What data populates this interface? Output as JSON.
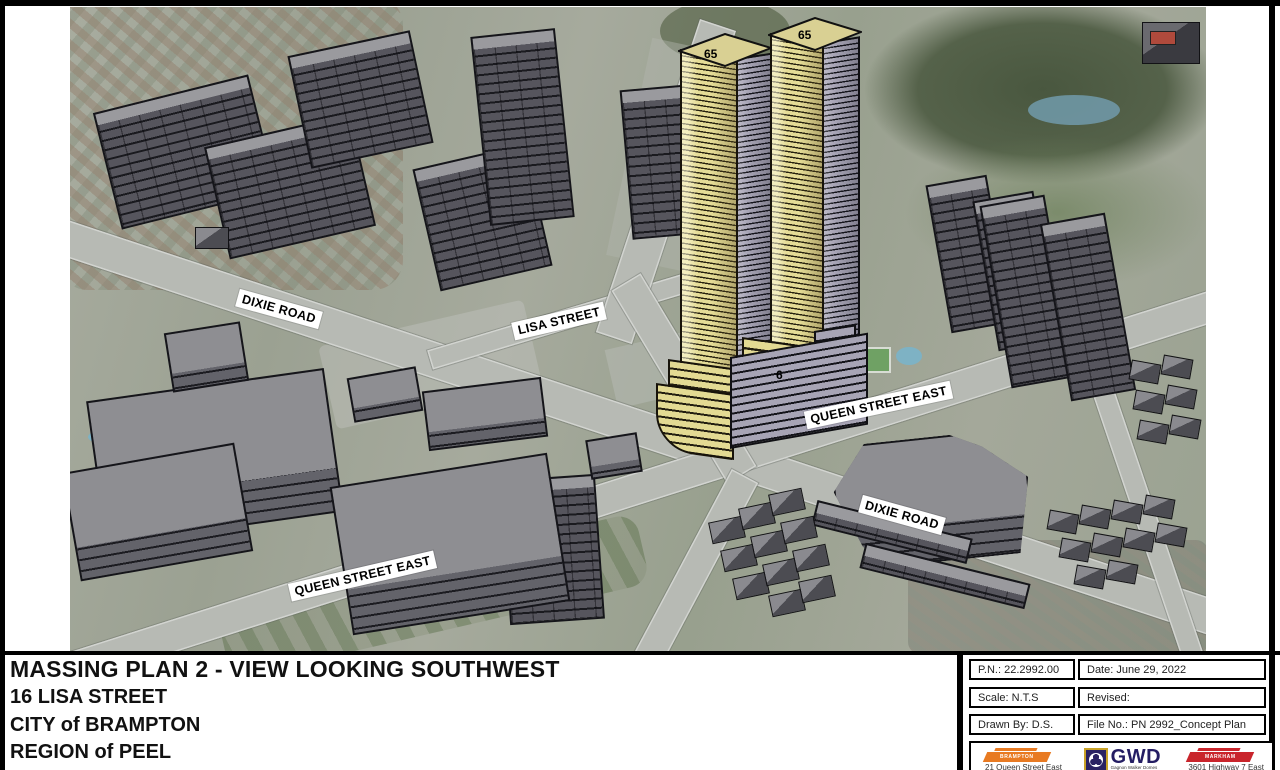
{
  "drawing": {
    "title": "MASSING PLAN 2 - VIEW LOOKING SOUTHWEST",
    "address": "16 LISA STREET",
    "city": "CITY of BRAMPTON",
    "region": "REGION of PEEL"
  },
  "titleblock": {
    "pn": "P.N.: 22.2992.00",
    "date": "Date: June 29, 2022",
    "scale": "Scale: N.T.S",
    "revised": "Revised:",
    "drawn_by": "Drawn By: D.S.",
    "file_no": "File No.: PN 2992_Concept Plan"
  },
  "logos": {
    "brampton_name": "BRAMPTON",
    "brampton_address": "21 Queen Street East",
    "gwd_acronym": "GWD",
    "gwd_fullname": "Gagnon Walker Domes",
    "markham_name": "MARKHAM",
    "markham_address": "3601 Highway 7 East"
  },
  "map_labels": {
    "dixie_road_nw": "DIXIE ROAD",
    "lisa_street": "LISA STREET",
    "queen_street_sw": "QUEEN STREET EAST",
    "queen_street_e": "QUEEN STREET EAST",
    "dixie_road_se": "DIXIE ROAD"
  },
  "proposed": {
    "tower1_storeys": "65",
    "tower2_storeys": "65",
    "podium_storeys": "6"
  },
  "colors": {
    "proposed_face_yellow": "#e5dc96",
    "proposed_side_gray": "#a8a5b6",
    "existing_massing_gray": "#56555d",
    "brampton_orange": "#e87a22",
    "markham_red": "#c9252c",
    "gwd_navy": "#2a2263",
    "gwd_gold": "#c9a227"
  }
}
